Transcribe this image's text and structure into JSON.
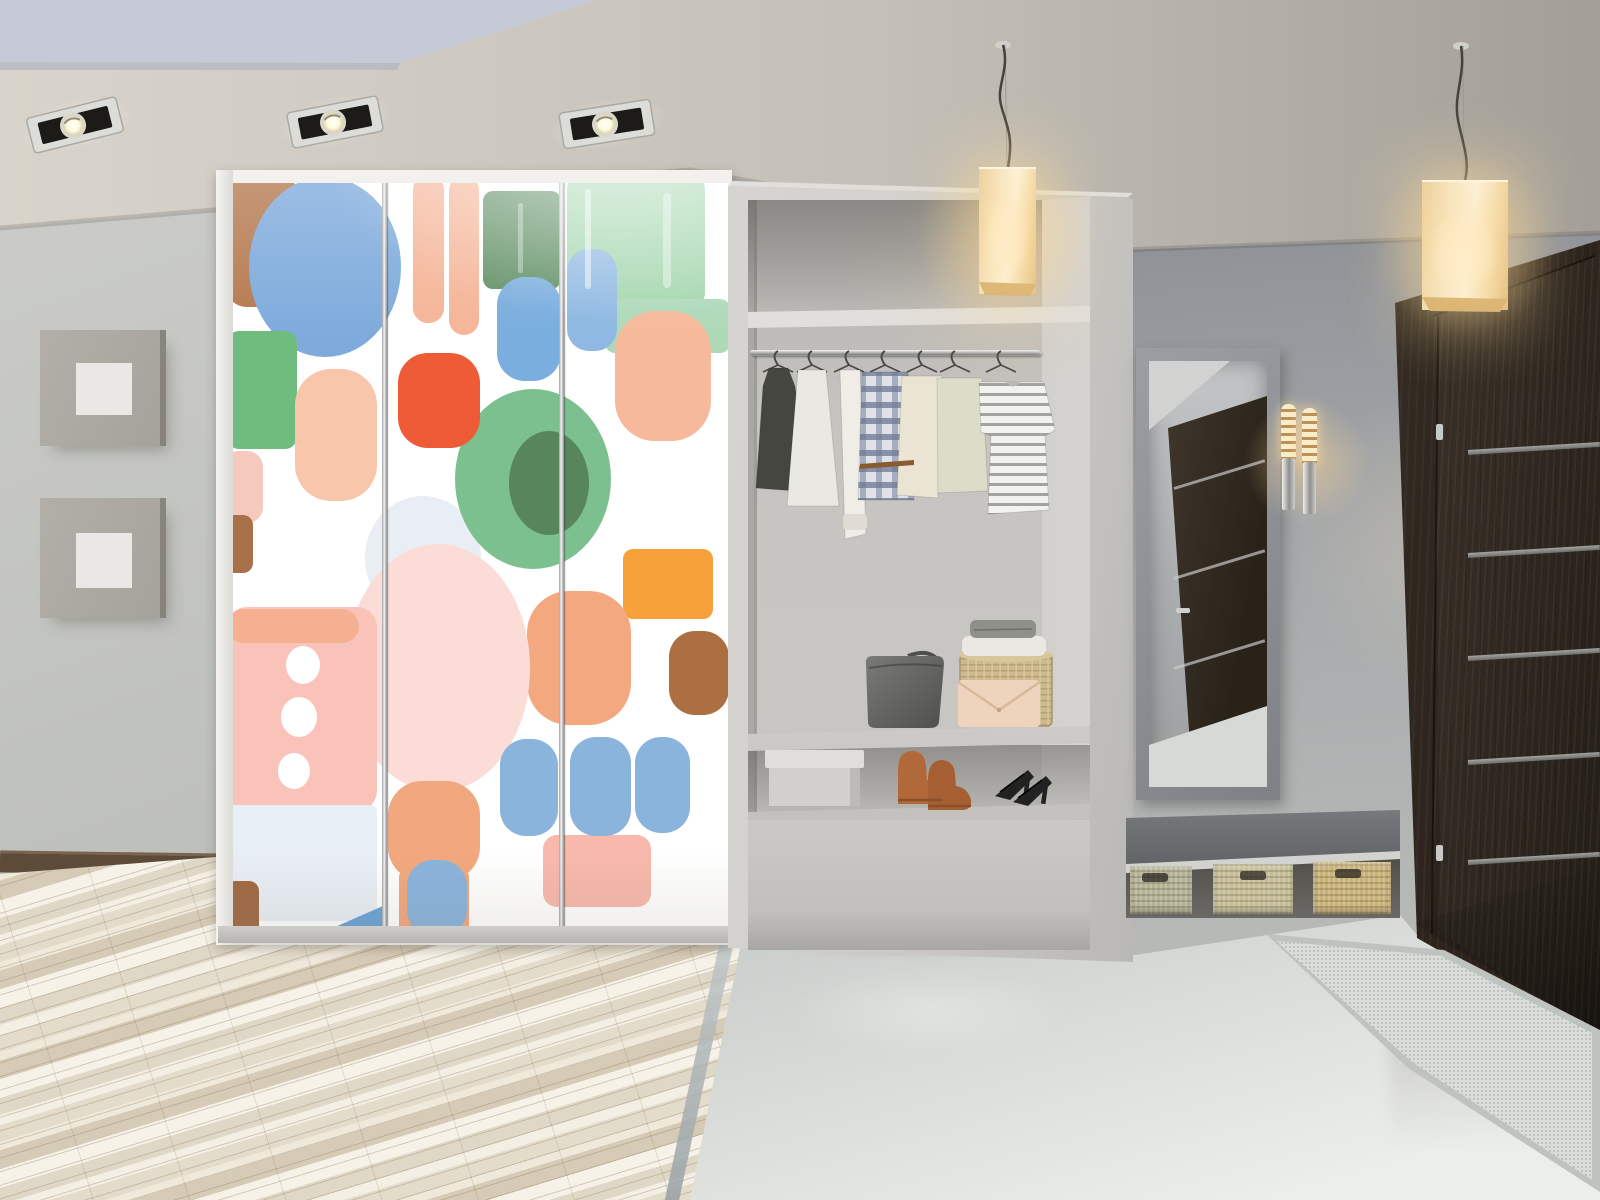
{
  "meta": {
    "description": "3D render of a modern hallway: sliding-door wardrobe with colorful abstract brush-stroke art, open closet niche with clothes and shoes, mirror, wall sconce, bench with wicker baskets, dark wenge entrance door, two glowing cube pendant lamps and three recessed ceiling spotlights.",
    "visible_text": ""
  },
  "palette": {
    "wallRight1": "#8e9196",
    "wallRight2": "#a7aaac",
    "wallRight3": "#babdb9",
    "wallLeft1": "#cbccc8",
    "wallLeft2": "#bdbfbb",
    "baseboard": "#5d4b39",
    "frameOuter1": "#b2afa9",
    "frameOuter2": "#a5a29b",
    "frameInner": "#e9e8e4",
    "tile1": "#c3c7c5",
    "tile2": "#eceeea",
    "woodLight": "#f4efe4",
    "woodMid": "#e4dccb",
    "woodDark": "#d6cbb6",
    "stripTrans1": "#c6ccce",
    "stripTrans2": "#97a0a4",
    "wardFrame": "#eceae6",
    "unitFront1": "#d4d2ce",
    "unitFront2": "#bab8b4",
    "nicheBack1": "#c6c4c0",
    "nicheBack2": "#b0aeaa",
    "nicheShadow": "#8b8985",
    "shelfEdge": "#dad8d4",
    "railHi": "#f2f2f0",
    "railLo": "#8c8c8a",
    "benchTop1": "#7b7e80",
    "benchTop2": "#5c5f61",
    "benchEdge": "#d2d2ce",
    "underBench": "#504e49",
    "doorWood1": "#3d352c",
    "doorWood2": "#221d16",
    "doorFrameWood": "#332c24",
    "stripMetal1": "#b2b2b0",
    "stripMetal2": "#757573",
    "hinge": "#c9c9c7",
    "mat1": "#bfc3c0",
    "mat2": "#dadedb",
    "mirrorFrame1": "#9b9ea3",
    "mirrorFrame2": "#7e8186",
    "glass1": "#c3c5c6",
    "glass2": "#9da09f",
    "reflDoor1": "#443a2f",
    "reflDoor2": "#282219",
    "lampShade1": "#fdf4dd",
    "lampShade2": "#e3bd7e",
    "lampBottom": "#d8b271",
    "glowWarm": "rgba(255,216,150,0.38)",
    "sconceGlass1": "#f8ecca",
    "sconceGlass2": "#bb9158",
    "chrome1": "#eeeeec",
    "chrome2": "#8f8f8d",
    "clutch": "#eed4bc",
    "boots": "#b2693a",
    "boots2": "#a65f33",
    "heels": "#222222",
    "shadowSoft": "rgba(60,55,45,0.35)"
  },
  "scene": {
    "ceiling": {
      "recessed_panel_color": "#c6c9d6",
      "spotlights": [
        {
          "cx": 75,
          "cy": 125,
          "rot": -14
        },
        {
          "cx": 335,
          "cy": 122,
          "rot": -11
        },
        {
          "cx": 607,
          "cy": 124,
          "rot": -9
        }
      ]
    },
    "wardrobe": {
      "panels": 3,
      "divider_x": [
        151.5,
        328.5
      ],
      "blobs": [
        {
          "t": "ellipse",
          "cx": 190,
          "cy": 375,
          "rx": 58,
          "ry": 62,
          "c": "#e9eef4"
        },
        {
          "t": "rect",
          "x": -8,
          "y": -6,
          "w": 76,
          "h": 130,
          "rx": 22,
          "c": "#b57a50"
        },
        {
          "t": "ellipse",
          "cx": 92,
          "cy": 84,
          "rx": 76,
          "ry": 90,
          "c": "#7fabdc"
        },
        {
          "t": "rect",
          "x": -6,
          "y": 148,
          "w": 70,
          "h": 118,
          "rx": 12,
          "c": "#6fbc7e"
        },
        {
          "t": "rect",
          "x": 62,
          "y": 186,
          "w": 82,
          "h": 132,
          "rx": 36,
          "c": "#f8c7ab"
        },
        {
          "t": "rect",
          "x": -10,
          "y": 268,
          "w": 40,
          "h": 72,
          "rx": 16,
          "c": "#f6c9be"
        },
        {
          "t": "rect",
          "x": -10,
          "y": 332,
          "w": 30,
          "h": 58,
          "rx": 10,
          "c": "#a8714a"
        },
        {
          "t": "rect",
          "x": 180,
          "y": -8,
          "w": 31,
          "h": 148,
          "rx": 15,
          "c": "#f5b598"
        },
        {
          "t": "rect",
          "x": 216,
          "y": -8,
          "w": 30,
          "h": 160,
          "rx": 15,
          "c": "#f5b598"
        },
        {
          "t": "rect",
          "x": 250,
          "y": 8,
          "w": 78,
          "h": 98,
          "rx": 10,
          "c": "#5e8e63"
        },
        {
          "t": "rect",
          "x": 264,
          "y": 94,
          "w": 64,
          "h": 104,
          "rx": 28,
          "c": "#7aaede"
        },
        {
          "t": "rect",
          "x": 334,
          "y": -6,
          "w": 138,
          "h": 128,
          "rx": 12,
          "c": "#a3d6ae"
        },
        {
          "t": "rect",
          "x": 372,
          "y": 116,
          "w": 125,
          "h": 54,
          "rx": 10,
          "c": "#aed9b9"
        },
        {
          "t": "rect",
          "x": 334,
          "y": 66,
          "w": 50,
          "h": 102,
          "rx": 22,
          "c": "#8fb9e2"
        },
        {
          "t": "rect",
          "x": 382,
          "y": 128,
          "w": 96,
          "h": 130,
          "rx": 40,
          "c": "#f6b99b"
        },
        {
          "t": "ellipse",
          "cx": 300,
          "cy": 296,
          "rx": 78,
          "ry": 90,
          "c": "#7cc08f"
        },
        {
          "t": "ellipse",
          "cx": 316,
          "cy": 300,
          "rx": 40,
          "ry": 52,
          "c": "#57865b"
        },
        {
          "t": "rect",
          "x": 165,
          "y": 170,
          "w": 82,
          "h": 95,
          "rx": 30,
          "c": "#ee5b37"
        },
        {
          "t": "rect",
          "x": 390,
          "y": 366,
          "w": 90,
          "h": 70,
          "rx": 10,
          "c": "#f6a13a"
        },
        {
          "t": "rect",
          "x": 436,
          "y": 448,
          "w": 60,
          "h": 84,
          "rx": 26,
          "c": "#ab6f42"
        },
        {
          "t": "rect",
          "x": 294,
          "y": 408,
          "w": 104,
          "h": 134,
          "rx": 42,
          "c": "#f3a87f"
        },
        {
          "t": "ellipse",
          "cx": 205,
          "cy": 485,
          "rx": 92,
          "ry": 124,
          "c": "#fbdcd6"
        },
        {
          "t": "rect",
          "x": -6,
          "y": 424,
          "w": 150,
          "h": 204,
          "rx": 20,
          "c": "#f9c3b9"
        },
        {
          "t": "rect",
          "x": -6,
          "y": 426,
          "w": 132,
          "h": 34,
          "rx": 17,
          "c": "#f5b092"
        },
        {
          "t": "ellipse",
          "cx": 70,
          "cy": 482,
          "rx": 17,
          "ry": 19,
          "c": "#ffffff"
        },
        {
          "t": "ellipse",
          "cx": 66,
          "cy": 534,
          "rx": 18,
          "ry": 20,
          "c": "#ffffff"
        },
        {
          "t": "ellipse",
          "cx": 61,
          "cy": 588,
          "rx": 16,
          "ry": 18,
          "c": "#ffffff"
        },
        {
          "t": "rect",
          "x": -6,
          "y": 622,
          "w": 150,
          "h": 116,
          "rx": 6,
          "c": "#e9eff6"
        },
        {
          "t": "rect",
          "x": 155,
          "y": 598,
          "w": 92,
          "h": 100,
          "rx": 34,
          "c": "#f2a87e"
        },
        {
          "t": "rect",
          "x": 166,
          "y": 688,
          "w": 28,
          "h": 64,
          "rx": 6,
          "c": "#f2a87e"
        },
        {
          "t": "rect",
          "x": 208,
          "y": 688,
          "w": 28,
          "h": 64,
          "rx": 6,
          "c": "#f2a87e"
        },
        {
          "t": "rect",
          "x": 174,
          "y": 677,
          "w": 60,
          "h": 76,
          "rx": 26,
          "c": "#8ab4dc"
        },
        {
          "t": "rect",
          "x": 310,
          "y": 652,
          "w": 108,
          "h": 72,
          "rx": 14,
          "c": "#f8b9ac"
        },
        {
          "t": "rect",
          "x": 267,
          "y": 556,
          "w": 58,
          "h": 97,
          "rx": 26,
          "c": "#8ab4dc"
        },
        {
          "t": "rect",
          "x": 337,
          "y": 554,
          "w": 61,
          "h": 99,
          "rx": 26,
          "c": "#8ab4dc"
        },
        {
          "t": "rect",
          "x": 402,
          "y": 554,
          "w": 55,
          "h": 96,
          "rx": 26,
          "c": "#8ab4dc"
        },
        {
          "t": "polygon",
          "pts": "77,755 152,722 152,755",
          "c": "#6ba4d6"
        },
        {
          "t": "rect",
          "x": -8,
          "y": 698,
          "w": 34,
          "h": 60,
          "rx": 10,
          "c": "#a06b45"
        },
        {
          "t": "rect",
          "x": 352,
          "y": 6,
          "w": 6,
          "h": 100,
          "rx": 3,
          "c": "#ffffff",
          "o": 0.5
        },
        {
          "t": "rect",
          "x": 430,
          "y": 10,
          "w": 8,
          "h": 95,
          "rx": 4,
          "c": "#ffffff",
          "o": 0.4
        },
        {
          "t": "rect",
          "x": 285,
          "y": 20,
          "w": 5,
          "h": 70,
          "rx": 2,
          "c": "#ffffff",
          "o": 0.35
        }
      ]
    },
    "closet": {
      "garments": [
        {
          "name": "dark-dress",
          "fill": "#45463f",
          "hx": 30,
          "path": "M21,30 L40,30 L47,48 L62,154 L8,150 L15,48 Z"
        },
        {
          "name": "white-dress",
          "fill": "#eae8e2",
          "hx": 64,
          "path": "M50,32 L78,32 L91,168 L39,168 Z"
        },
        {
          "name": "white-robe",
          "fill": "#f0ede7",
          "hx": 101,
          "path": "M92,32 L112,32 L118,196 L97,201 Z"
        },
        {
          "name": "plaid-shirt",
          "fill": "url(#pat-plaid)",
          "hx": 137,
          "path": "M114,34 L160,34 L166,162 L110,162 Z"
        },
        {
          "name": "cream-top",
          "fill": "#ebe4d2",
          "hx": 174,
          "path": "M154,38 L194,38 L190,160 L149,157 Z"
        },
        {
          "name": "knit-sweater",
          "fill": "#dcddc8",
          "hx": 207,
          "path": "M189,40 L234,40 L240,153 L190,155 Z"
        },
        {
          "name": "striped-tee",
          "fill": "url(#pat-stripes)",
          "hx": 253,
          "path": "M231,44 L296,44 L307,92 L297,98 L301,172 L240,176 L243,98 L233,94 Z"
        }
      ],
      "shelf_items": [
        "gray-handbag",
        "beige-clutch",
        "wicker-basket",
        "folded-clothes"
      ],
      "floor_items": [
        "white-box",
        "brown-boots",
        "black-heels"
      ]
    },
    "door": {
      "strips_y": [
        220,
        323,
        426,
        530,
        630
      ],
      "hinges_y": [
        194,
        615
      ]
    },
    "mirror": {
      "reflection_strips_y": [
        126,
        216,
        306,
        386
      ]
    },
    "baskets": [
      {
        "x": 1130,
        "y": 866,
        "w": 62,
        "h": 48,
        "c": "#b5b295",
        "hx": 12,
        "hy": 7
      },
      {
        "x": 1213,
        "y": 864,
        "w": 80,
        "h": 50,
        "c": "#c6bd96",
        "hx": 27,
        "hy": 7
      },
      {
        "x": 1313,
        "y": 862,
        "w": 78,
        "h": 52,
        "c": "#c9b279",
        "hx": 22,
        "hy": 7
      }
    ],
    "lighting": {
      "pendant_lamps": 2,
      "spotlights": 3,
      "sconce_lamps": 2
    }
  }
}
